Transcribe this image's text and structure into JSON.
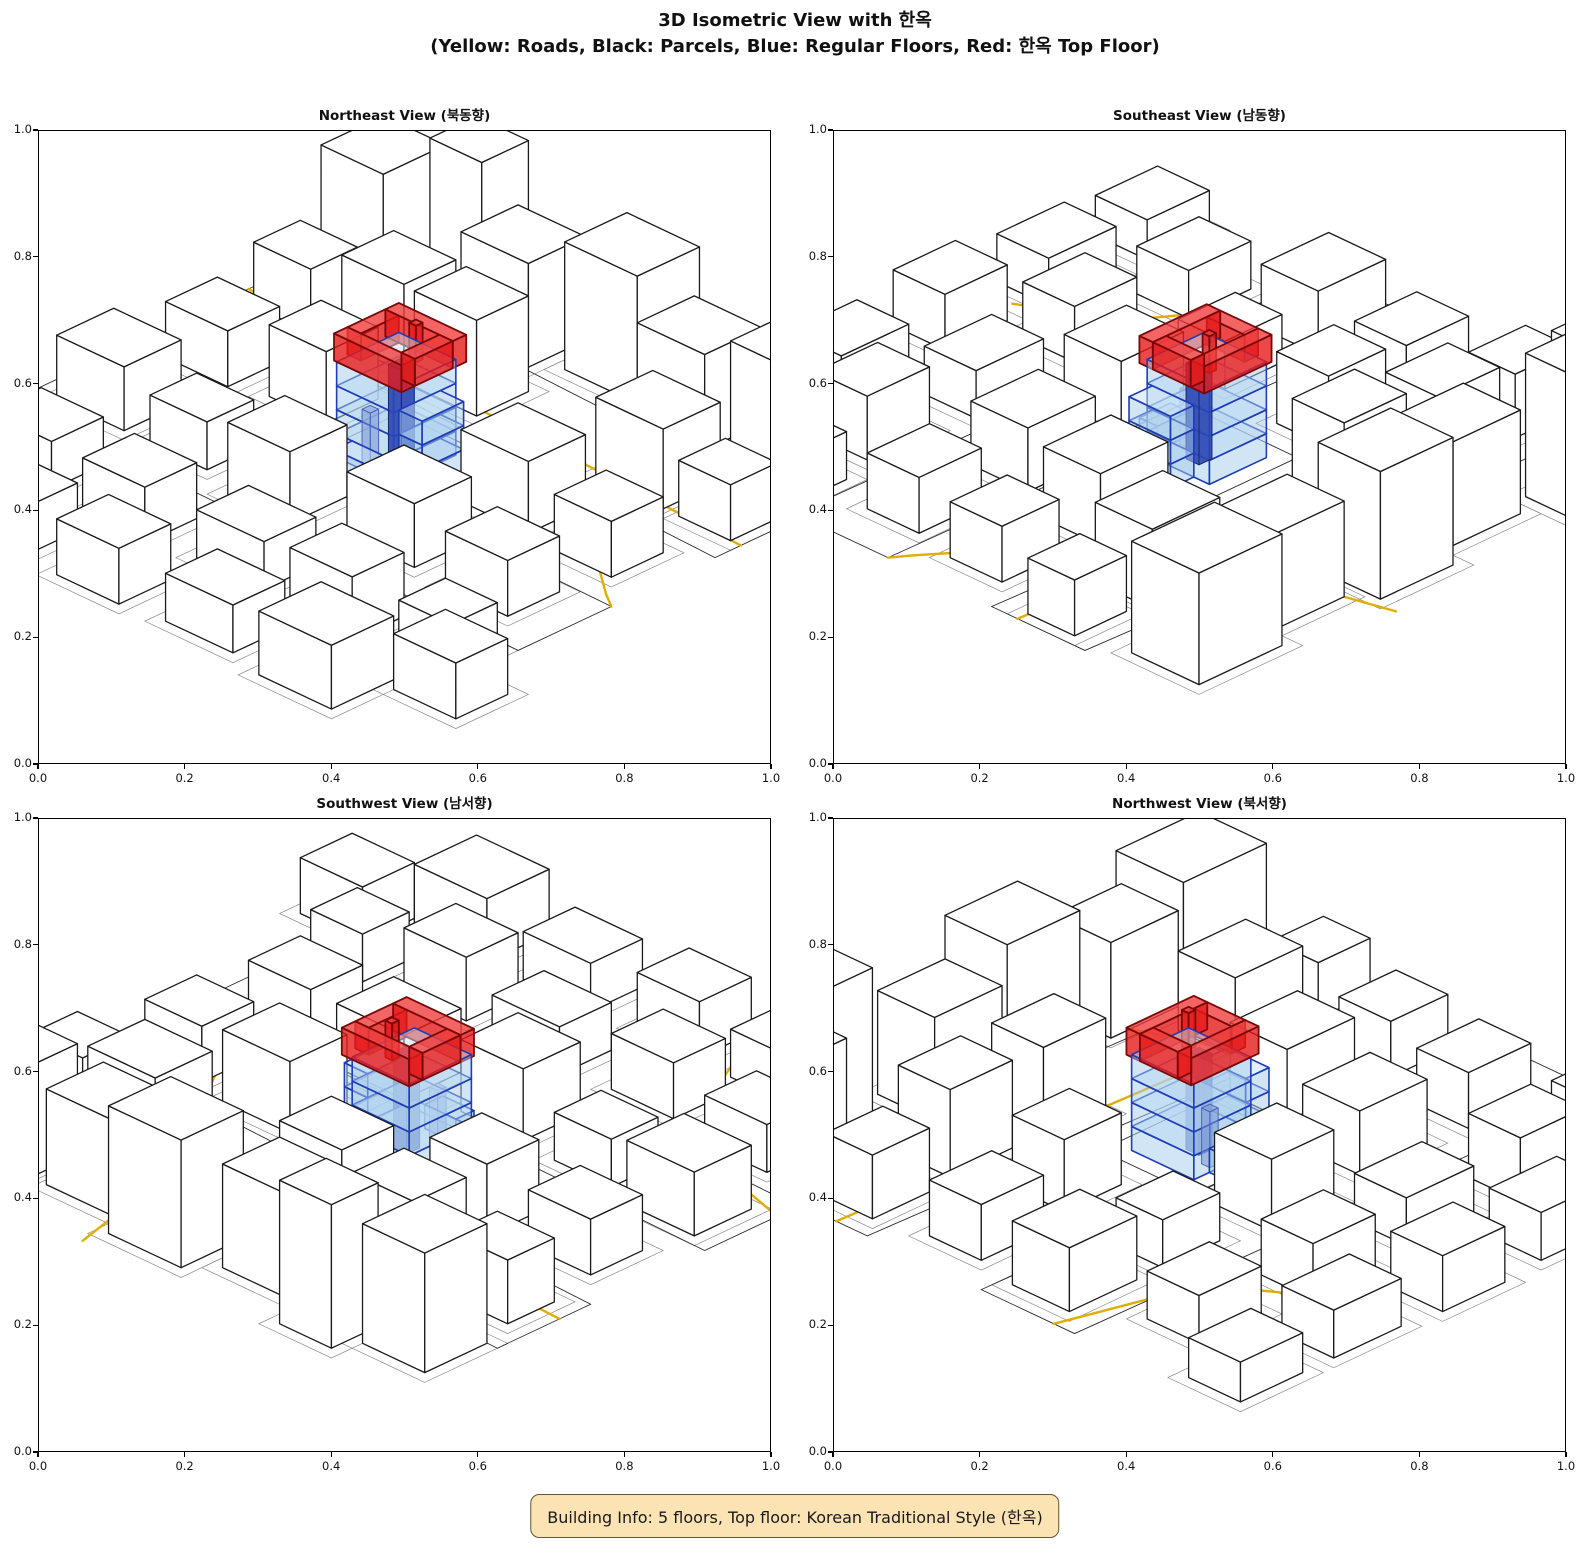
{
  "figure": {
    "suptitle_line1": "3D Isometric View with 한옥",
    "suptitle_line2": "(Yellow: Roads, Black: Parcels, Blue: Regular Floors, Red: 한옥 Top Floor)"
  },
  "views": [
    {
      "id": "northeast",
      "title": "Northeast View (북동향)",
      "rotation_deg": 0
    },
    {
      "id": "southeast",
      "title": "Southeast View (남동향)",
      "rotation_deg": 90
    },
    {
      "id": "southwest",
      "title": "Southwest View (남서향)",
      "rotation_deg": 180
    },
    {
      "id": "northwest",
      "title": "Northwest View (북서향)",
      "rotation_deg": 270
    }
  ],
  "axes": {
    "xlim": [
      0.0,
      1.0
    ],
    "ylim": [
      0.0,
      1.0
    ],
    "x_ticks": [
      "0.0",
      "0.2",
      "0.4",
      "0.6",
      "0.8",
      "1.0"
    ],
    "y_ticks": [
      "0.0",
      "0.2",
      "0.4",
      "0.6",
      "0.8",
      "1.0"
    ]
  },
  "info_box": {
    "text": "Building Info: 5 floors, Top floor: Korean Traditional Style (한옥)"
  },
  "colors": {
    "road": "#e0ae00",
    "parcel_line": "#2b2b2b",
    "parcel_line_light": "#8a8a8a",
    "building_fill": "#ffffff",
    "building_edge": "#1a1a1a",
    "floor_fill": "rgba(166,204,236,0.50)",
    "floor_top_fill": "rgba(199,225,245,0.50)",
    "floor_edge": "#1e3cb5",
    "core_fill": "rgba(43,70,180,0.90)",
    "core_edge": "#16256e",
    "pillar_fill": "rgba(122,148,212,0.55)",
    "pillar_edge": "#4b63b8",
    "hanok_fill": "rgba(230,26,26,0.80)",
    "hanok_top_fill": "rgba(240,62,62,0.80)",
    "hanok_edge": "#7c0707",
    "info_bg": "#fbe3b4",
    "info_border": "#5f5535",
    "info_text": "#1a1a1a"
  },
  "chart_data": {
    "type": "3d-isometric-city",
    "title": "3D Isometric View with 한옥",
    "subtitle": "(Yellow: Roads, Black: Parcels, Blue: Regular Floors, Red: 한옥 Top Floor)",
    "legend": {
      "yellow": "Roads",
      "black": "Parcels",
      "blue": "Regular Floors",
      "red": "한옥 Top Floor"
    },
    "building_info": {
      "floors": 5,
      "top_floor_style": "Korean Traditional (한옥)"
    },
    "views": [
      "Northeast (북동향)",
      "Southeast (남동향)",
      "Southwest (남서향)",
      "Northwest (북서향)"
    ],
    "axis_ticks": [
      0.0,
      0.2,
      0.4,
      0.6,
      0.8,
      1.0
    ],
    "scene": {
      "blocks": [
        [
          2,
          6,
          12,
          12,
          15
        ],
        [
          16,
          2,
          10,
          9,
          18
        ],
        [
          30,
          8,
          13,
          11,
          13
        ],
        [
          47,
          4,
          14,
          12,
          16
        ],
        [
          64,
          8,
          13,
          11,
          12
        ],
        [
          80,
          4,
          16,
          13,
          14
        ],
        [
          4,
          24,
          11,
          9,
          8
        ],
        [
          20,
          22,
          12,
          10,
          11
        ],
        [
          36,
          24,
          12,
          10,
          12
        ],
        [
          72,
          24,
          13,
          11,
          10
        ],
        [
          88,
          26,
          10,
          9,
          7
        ],
        [
          6,
          42,
          12,
          10,
          7
        ],
        [
          24,
          40,
          11,
          10,
          9
        ],
        [
          64,
          42,
          13,
          11,
          9
        ],
        [
          83,
          44,
          11,
          10,
          7
        ],
        [
          4,
          60,
          13,
          11,
          8
        ],
        [
          22,
          62,
          11,
          9,
          6
        ],
        [
          40,
          63,
          12,
          11,
          9
        ],
        [
          60,
          60,
          13,
          11,
          8
        ],
        [
          80,
          62,
          12,
          10,
          7
        ],
        [
          10,
          80,
          12,
          10,
          6
        ],
        [
          30,
          82,
          12,
          10,
          7
        ],
        [
          50,
          80,
          13,
          10,
          6
        ],
        [
          70,
          82,
          12,
          10,
          8
        ],
        [
          88,
          80,
          10,
          9,
          6
        ],
        [
          20,
          96,
          13,
          10,
          6
        ],
        [
          40,
          97,
          12,
          10,
          7
        ],
        [
          60,
          96,
          13,
          10,
          6
        ],
        [
          80,
          96,
          14,
          12,
          8
        ],
        [
          96,
          88,
          12,
          10,
          7
        ],
        [
          2,
          96,
          12,
          10,
          5
        ]
      ],
      "parcels": [
        [
          [
            0,
            18
          ],
          [
            100,
            22
          ],
          [
            100,
            40
          ],
          [
            0,
            36
          ]
        ],
        [
          [
            0,
            58
          ],
          [
            100,
            60
          ],
          [
            100,
            78
          ],
          [
            0,
            76
          ]
        ],
        [
          [
            40,
            41
          ],
          [
            61,
            41
          ],
          [
            61,
            59
          ],
          [
            40,
            59
          ]
        ]
      ],
      "roads": [
        [
          [
            0,
            30
          ],
          [
            30,
            31.5
          ],
          [
            60,
            33
          ],
          [
            100,
            35
          ]
        ],
        [
          [
            62,
            0
          ],
          [
            65,
            12
          ],
          [
            72,
            30
          ],
          [
            84,
            48
          ],
          [
            97,
            58
          ],
          [
            100,
            60
          ]
        ],
        [
          [
            0,
            72
          ],
          [
            14,
            76
          ],
          [
            26,
            84
          ],
          [
            34,
            96
          ],
          [
            36,
            100
          ]
        ]
      ],
      "highlight": {
        "blue_floors": [
          [
            43,
            44,
            11,
            12,
            0,
            3
          ],
          [
            43,
            44,
            11,
            12,
            3,
            3
          ],
          [
            43,
            44,
            11,
            12,
            6,
            3
          ],
          [
            43,
            44,
            11,
            12,
            9,
            3
          ],
          [
            54,
            47,
            4.5,
            8,
            0,
            3
          ],
          [
            54,
            47,
            4.5,
            8,
            3,
            3
          ],
          [
            54,
            47,
            4.5,
            8,
            6,
            3
          ],
          [
            46,
            56,
            6,
            3.5,
            0,
            3
          ]
        ],
        "cores": [
          [
            48.5,
            49,
            2.5,
            2.5,
            0,
            12
          ]
        ],
        "pillars": [
          [
            47,
            53.5,
            1.6,
            1.6,
            0,
            7
          ]
        ],
        "red_top": [
          [
            42.5,
            43.5,
            13,
            2.6,
            12,
            3.4
          ],
          [
            42.5,
            53.4,
            13,
            2.6,
            12,
            3.4
          ],
          [
            42.5,
            46.1,
            2.6,
            7.3,
            12,
            3.4
          ],
          [
            52.9,
            46.1,
            2.6,
            7.3,
            12,
            3.4
          ],
          [
            49.5,
            47.2,
            1.3,
            1.3,
            12,
            4.6
          ]
        ]
      }
    }
  }
}
